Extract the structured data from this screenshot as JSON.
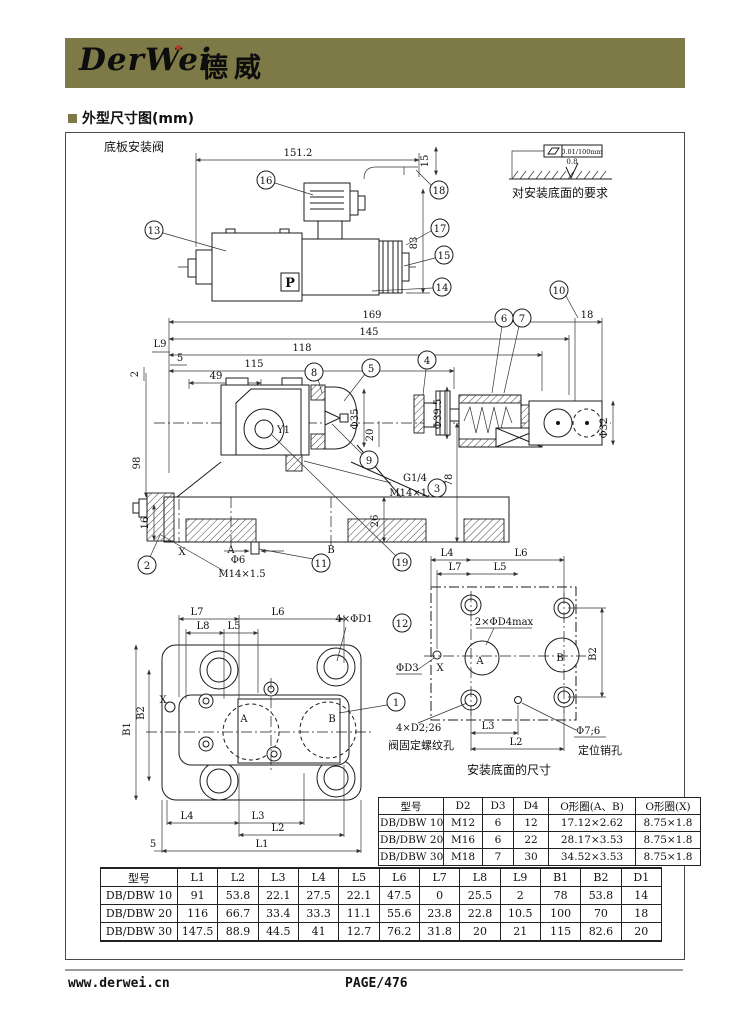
{
  "header": {
    "logo_latin": "DerWei",
    "logo_cn": "德威",
    "bar_color": "#7d7a47"
  },
  "section": {
    "title": "外型尺寸图(mm)"
  },
  "top_view": {
    "caption": "底板安装阀",
    "p_label": "P",
    "dims": {
      "w1512": "151.2",
      "h15": "15",
      "h83": "83",
      "w169": "169",
      "w145": "145"
    },
    "callouts": {
      "c13": "13",
      "c14": "14",
      "c15": "15",
      "c16": "16",
      "c17": "17",
      "c18": "18"
    }
  },
  "surface_req": {
    "flatness": "0.01/100mm",
    "roughness": "0.8",
    "caption": "对安装底面的要求"
  },
  "mid_view": {
    "dims": {
      "w118": "118",
      "w115": "115",
      "w49": "49",
      "l9": "L9",
      "n5": "5",
      "n2": "2",
      "h98": "98",
      "h16": "16",
      "d35": "Φ35",
      "n20": "20",
      "d395": "Φ39.5",
      "n18": "18",
      "d32": "Φ32",
      "h78": "78",
      "h26": "26",
      "g14": "G1/4",
      "m14_top": "M14×1.5",
      "m14_bot": "M14×1.5",
      "d6": "Φ6",
      "x": "X",
      "a": "A",
      "b": "B",
      "y1": "Y1"
    },
    "callouts": {
      "c2": "2",
      "c3": "3",
      "c4": "4",
      "c5": "5",
      "c6": "6",
      "c7": "7",
      "c8": "8",
      "c9": "9",
      "c10": "10",
      "c11": "11",
      "c19": "19"
    }
  },
  "bl_view": {
    "dims": {
      "l7": "L7",
      "l6": "L6",
      "l8": "L8",
      "l5": "L5",
      "d1": "4×ΦD1",
      "b1": "B1",
      "b2": "B2",
      "l4": "L4",
      "l3": "L3",
      "l2": "L2",
      "l1": "L1",
      "n5": "5",
      "x": "X",
      "a": "A",
      "b": "B"
    },
    "callouts": {
      "c1": "1",
      "c12": "12"
    }
  },
  "br_view": {
    "dims": {
      "l4": "L4",
      "l6": "L6",
      "l7": "L7",
      "l5": "L5",
      "d4max": "2×ΦD4max",
      "d3": "ΦD3",
      "b2": "B2",
      "l3": "L3",
      "l2": "L2",
      "d2": "4×D2;26",
      "pin": "Φ7;6",
      "x": "X",
      "a": "A",
      "b": "B"
    },
    "notes": {
      "thread": "阀固定螺纹孔",
      "pin": "定位销孔",
      "caption": "安装底面的尺寸"
    }
  },
  "small_table": {
    "headers": [
      "型号",
      "D2",
      "D3",
      "D4",
      "O形圈(A、B)",
      "O形圈(X)"
    ],
    "rows": [
      [
        "DB/DBW 10",
        "M12",
        "6",
        "12",
        "17.12×2.62",
        "8.75×1.8"
      ],
      [
        "DB/DBW 20",
        "M16",
        "6",
        "22",
        "28.17×3.53",
        "8.75×1.8"
      ],
      [
        "DB/DBW 30",
        "M18",
        "7",
        "30",
        "34.52×3.53",
        "8.75×1.8"
      ]
    ]
  },
  "big_table": {
    "headers": [
      "型号",
      "L1",
      "L2",
      "L3",
      "L4",
      "L5",
      "L6",
      "L7",
      "L8",
      "L9",
      "B1",
      "B2",
      "D1"
    ],
    "rows": [
      [
        "DB/DBW 10",
        "91",
        "53.8",
        "22.1",
        "27.5",
        "22.1",
        "47.5",
        "0",
        "25.5",
        "2",
        "78",
        "53.8",
        "14"
      ],
      [
        "DB/DBW 20",
        "116",
        "66.7",
        "33.4",
        "33.3",
        "11.1",
        "55.6",
        "23.8",
        "22.8",
        "10.5",
        "100",
        "70",
        "18"
      ],
      [
        "DB/DBW 30",
        "147.5",
        "88.9",
        "44.5",
        "41",
        "12.7",
        "76.2",
        "31.8",
        "20",
        "21",
        "115",
        "82.6",
        "20"
      ]
    ]
  },
  "footer": {
    "site": "www.derwei.cn",
    "page": "PAGE/476"
  }
}
